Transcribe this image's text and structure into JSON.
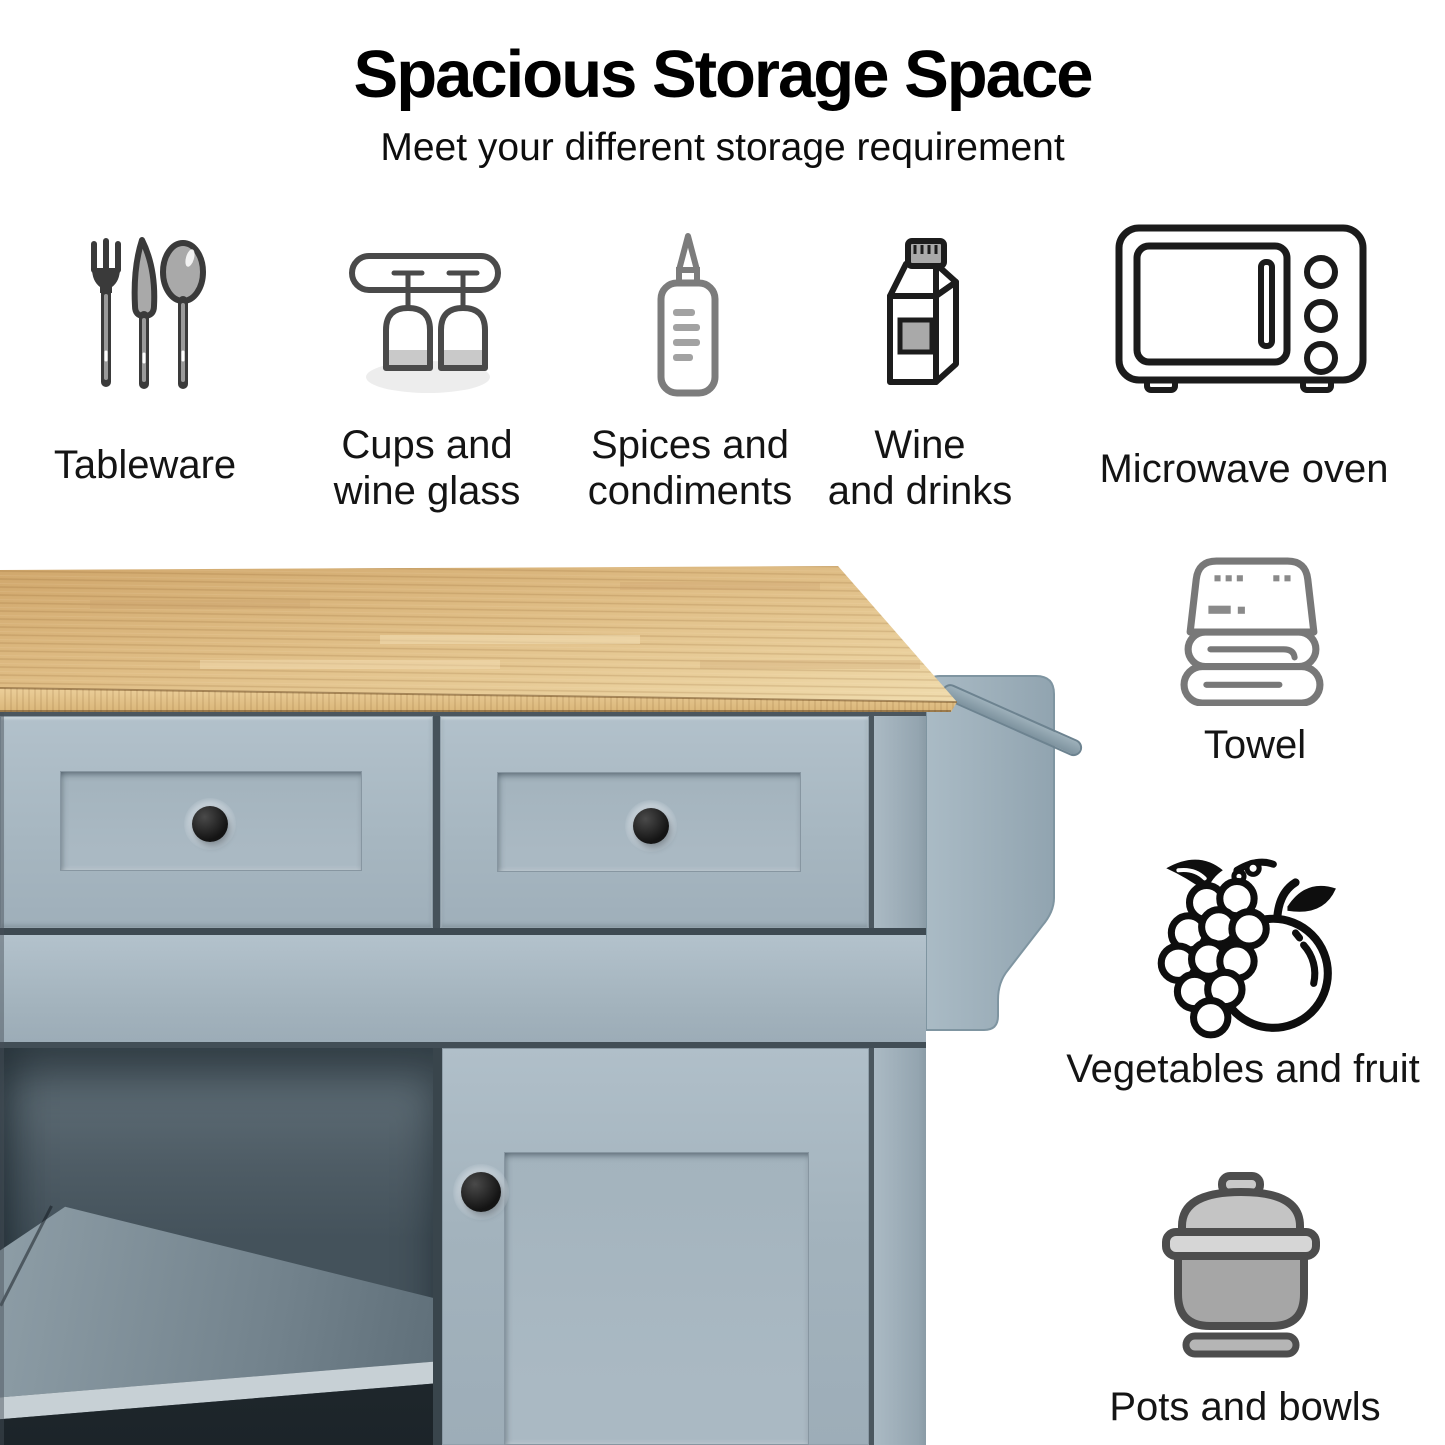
{
  "header": {
    "title": "Spacious Storage Space",
    "subtitle": "Meet your different storage requirement"
  },
  "top_row": [
    {
      "icon": "cutlery-icon",
      "label_lines": [
        "Tableware"
      ]
    },
    {
      "icon": "wine-glass-rack-icon",
      "label_lines": [
        "Cups and",
        "wine glass"
      ]
    },
    {
      "icon": "squeeze-bottle-icon",
      "label_lines": [
        "Spices and",
        "condiments"
      ]
    },
    {
      "icon": "drink-carton-icon",
      "label_lines": [
        "Wine",
        "and drinks"
      ]
    },
    {
      "icon": "microwave-oven-icon",
      "label_lines": [
        "Microwave oven"
      ]
    }
  ],
  "side_column": [
    {
      "icon": "towel-icon",
      "label_lines": [
        "Towel"
      ]
    },
    {
      "icon": "fruits-icon",
      "label_lines": [
        "Vegetables and fruit"
      ]
    },
    {
      "icon": "pot-icon",
      "label_lines": [
        "Pots and bowls"
      ]
    }
  ],
  "colors": {
    "cabinet": "#a8b7c1",
    "cabinet_deep": "#8fa0ab",
    "gap": "#46525a",
    "wood": "#d8b279",
    "wood_light": "#ecd7a6",
    "wood_band": "#e2c18a",
    "interior": "#4e5c65",
    "interior_dark": "#1d262b",
    "shelf_edge": "#c7d0d5",
    "knob": "#1b1b1b",
    "rack": "#9fb2bc",
    "text": "#0f0f0f",
    "icon_dark": "#1c1c1c",
    "icon_mid": "#7c7c7c",
    "icon_fill": "#a9a9a9"
  }
}
